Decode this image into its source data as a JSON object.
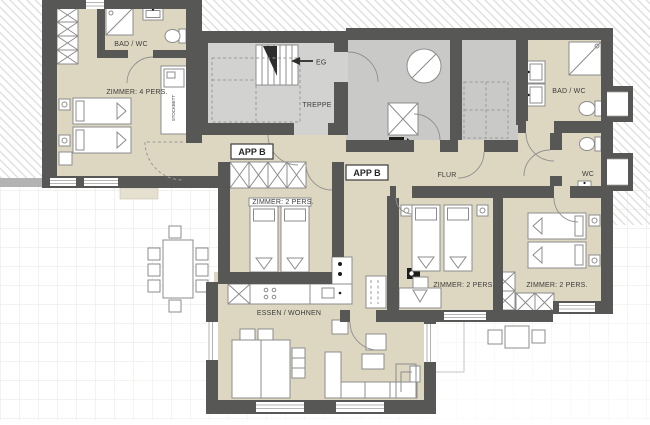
{
  "labels": {
    "app_b_1": "APP B",
    "app_b_2": "APP B",
    "treppe": "TREPPE",
    "eg": "EG",
    "flur": "FLUR",
    "bad_wc_left": "BAD / WC",
    "bad_wc_right": "BAD / WC",
    "wc": "WC",
    "zimmer_4": "ZIMMER: 4 PERS.",
    "zimmer_2_a": "ZIMMER: 2 PERS.",
    "zimmer_2_b": "ZIMMER: 2 PERS.",
    "zimmer_2_c": "ZIMMER: 2 PERS.",
    "essen_wohnen": "ESSEN / WOHNEN",
    "stockbett": "STOCKBETT"
  },
  "colors": {
    "wall": "#575756",
    "room_floor": "#ddd6c0",
    "stair_floor": "#d2d2d1",
    "tech_floor": "#c9c9c8",
    "hatch_line": "#dcdcdc",
    "terrace_grid": "#e9e6e0",
    "furniture_stroke": "#8c8c8c",
    "label_text": "#3c3c3c",
    "dark_accent": "#2e2e2d"
  }
}
